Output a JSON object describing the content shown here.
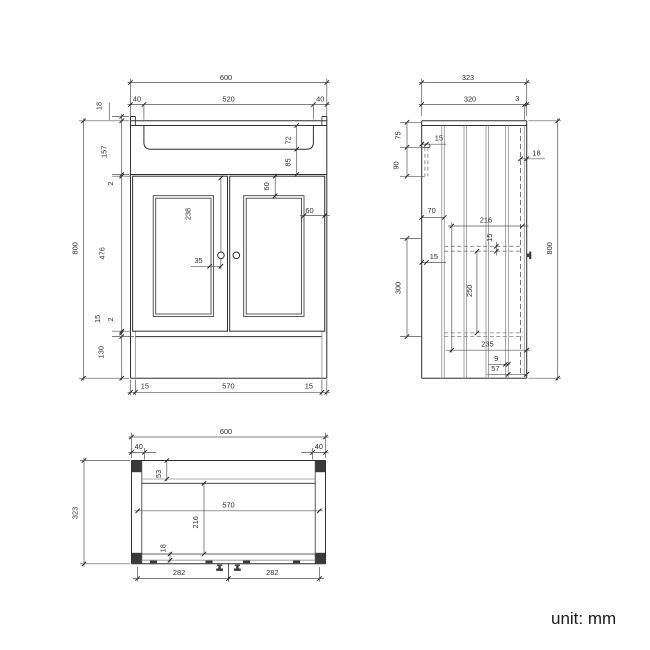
{
  "unit_label": "unit: mm",
  "colors": {
    "line": "#2f2f2f",
    "dim_line": "#555555",
    "background": "#ffffff"
  },
  "front": {
    "width": "600",
    "basin_width": "520",
    "overhang_left": "40",
    "overhang_right": "40",
    "top_thickness": "18",
    "upper_height": "157",
    "gap_top": "2",
    "basin_depth": "72",
    "basin_clearance": "85",
    "total_height": "800",
    "door_height": "476",
    "panel_inset_top": "60",
    "panel_inset_side": "60",
    "handle_from_top": "238",
    "handle_offset": "35",
    "gap_bottom": "2",
    "bottom_rail": "15",
    "plinth_height": "130",
    "side_panel_left": "15",
    "interior_width": "570",
    "side_panel_right": "15"
  },
  "side": {
    "depth_total": "323",
    "depth_top": "320",
    "back_gap": "3",
    "bracket_top_offset": "75",
    "bracket_height": "90",
    "bracket_inset": "15",
    "door_thickness": "18",
    "hinge_offset": "70",
    "shelf_depth": "216",
    "shelf_thickness": "15",
    "back_panel": "15",
    "opening_height": "300",
    "shelf_to_bottom": "250",
    "bottom_depth": "235",
    "leg_thickness": "9",
    "plinth_setback": "57",
    "total_height": "800"
  },
  "plan": {
    "width_total": "600",
    "corner_left": "40",
    "corner_right": "40",
    "depth_total": "323",
    "back_offset": "53",
    "interior_width": "570",
    "interior_depth": "216",
    "door_thickness": "18",
    "handle_span_left": "282",
    "handle_span_right": "282"
  }
}
